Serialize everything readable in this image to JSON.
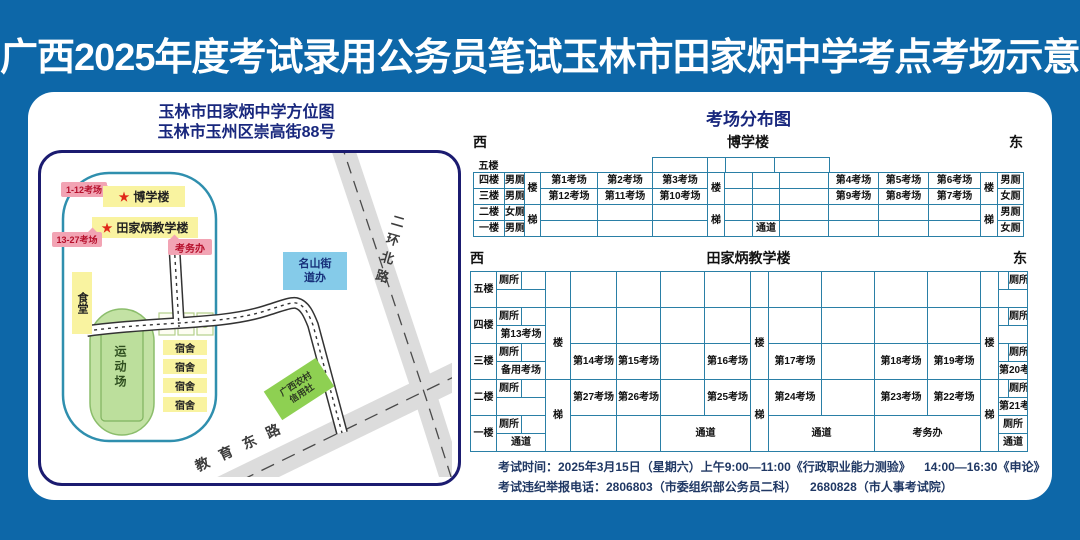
{
  "title": "广西2025年度考试录用公务员笔试玉林市田家炳中学考点考场示意图",
  "palette": {
    "background_blue": "#0d67a8",
    "heading_navy": "#18277d",
    "table_border_teal": "#2a7fa6",
    "building_yellow": "#f9f3a0",
    "callout_pink": "#f2a4b4",
    "callout_text_red": "#b6102c",
    "office_blue": "#85cbe9",
    "bank_green": "#8ed052",
    "field_green": "#c3e2a4",
    "road_gray": "#dcdcdc",
    "star_red": "#e02818"
  },
  "map": {
    "heading1": "玉林市田家炳中学方位图",
    "heading2": "玉林市玉州区崇高街88号",
    "star": "★",
    "badge_boxue": "1-12考场",
    "boxue": "博学楼",
    "badge_tjb": "13-27考场",
    "tianjiabing": "田家炳教学楼",
    "exam_office": "考务办",
    "canteen": "食堂",
    "street_office_line1": "名山街",
    "street_office_line2": "道办",
    "sports_field": "运动场",
    "dorm": "宿舍",
    "credit_line1": "广西农村",
    "credit_line2": "信用社",
    "road_north": "二环北路",
    "road_east": "教育东路"
  },
  "dist": {
    "heading": "考场分布图",
    "west": "西",
    "east": "东",
    "boxue": {
      "name": "博学楼",
      "floors": [
        "五楼",
        "四楼",
        "三楼",
        "二楼",
        "一楼"
      ],
      "left_toilets": [
        "男厕",
        "男厕",
        "女厕",
        "男厕"
      ],
      "right_toilets": [
        "男厕",
        "女厕",
        "男厕",
        "女厕"
      ],
      "stair_upper": "楼",
      "stair_lower": "梯",
      "f4_left": [
        "第1考场",
        "第2考场",
        "第3考场"
      ],
      "f3_left": [
        "第12考场",
        "第11考场",
        "第10考场"
      ],
      "f4_right": [
        "第4考场",
        "第5考场",
        "第6考场"
      ],
      "f3_right": [
        "第9考场",
        "第8考场",
        "第7考场"
      ],
      "corridor": "通道"
    },
    "tjb": {
      "name": "田家炳教学楼",
      "floors": [
        "五楼",
        "四楼",
        "三楼",
        "二楼",
        "一楼"
      ],
      "toilet": "厕所",
      "stair_upper": "楼",
      "stair_lower": "梯",
      "left_bottom": [
        "",
        "第13考场",
        "备用考场",
        "",
        "通道"
      ],
      "right_bottom": [
        "",
        "",
        "第20考场",
        "第21考场",
        "通道"
      ],
      "f3_left": [
        "第14考场",
        "第15考场",
        "",
        "第16考场"
      ],
      "f2_left": [
        "第27考场",
        "第26考场",
        "",
        "第25考场"
      ],
      "f3_right": [
        "第17考场",
        "",
        "第18考场",
        "第19考场"
      ],
      "f2_right": [
        "第24考场",
        "",
        "第23考场",
        "第22考场"
      ],
      "corridor": "通道",
      "exam_office": "考务办"
    }
  },
  "footer": {
    "line1": "考试时间：2025年3月15日（星期六）上午9:00—11:00《行政职业能力测验》    14:00—16:30《申论》",
    "line2": "考试违纪举报电话：2806803（市委组织部公务员二科）    2680828（市人事考试院）"
  }
}
